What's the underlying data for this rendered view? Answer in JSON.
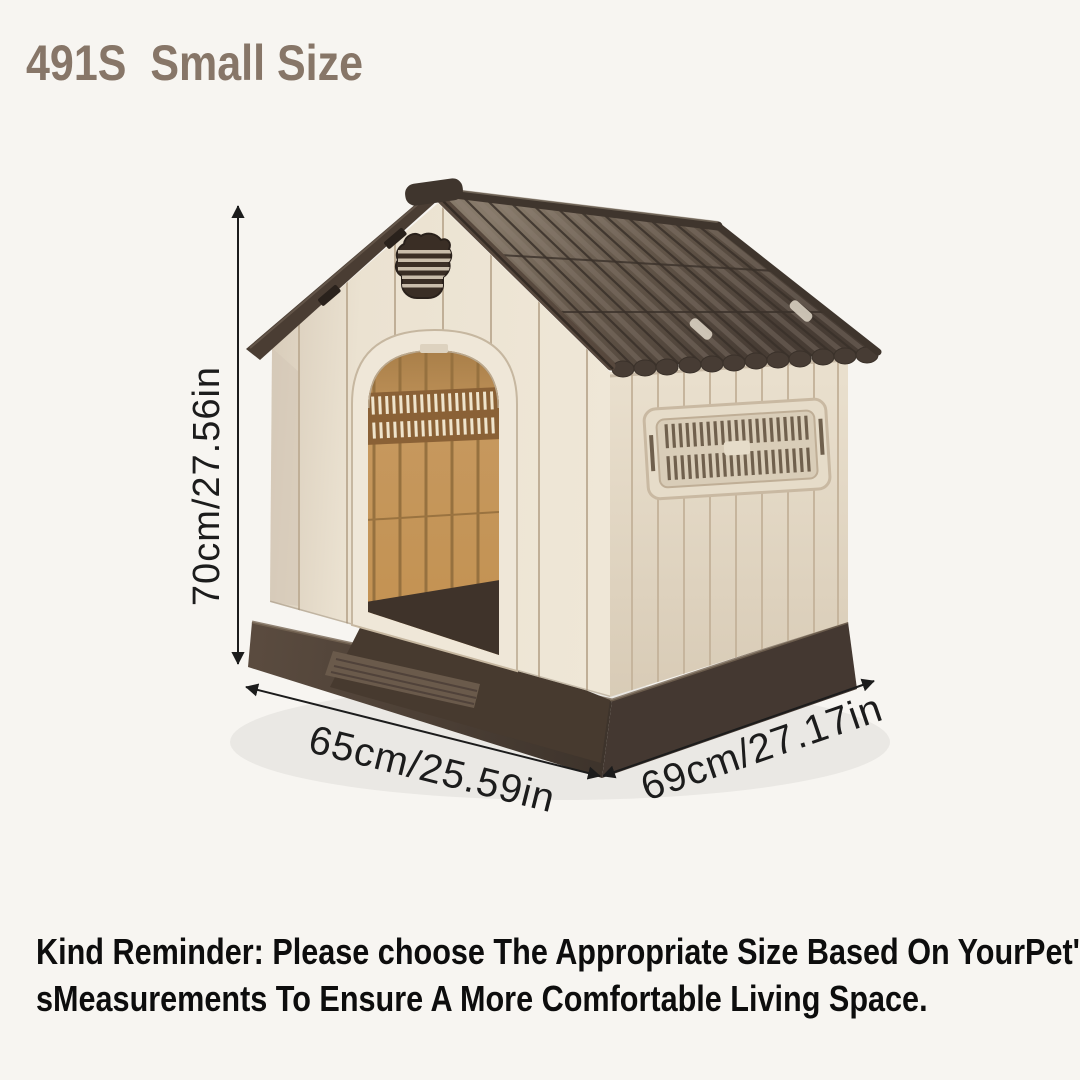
{
  "palette": {
    "bg": "#f7f5f1",
    "title-color": "#877668",
    "dim-ink": "#1c1c1c",
    "reminder-ink": "#0d0d0d",
    "roof": "#5f5349",
    "roof-trim": "#3c332b",
    "wall": "#eae1d0",
    "wall-side": "#e2d8c5",
    "interior": "#c6985e",
    "base": "#4e4237",
    "emblem": "#3a2e25"
  },
  "header": {
    "title": "491S  Small Size"
  },
  "figure": {
    "label": "dog-house-product-illustration",
    "dimensions": {
      "height_label": "70cm/27.56in",
      "width_label": "65cm/25.59in",
      "depth_label": "69cm/27.17in"
    }
  },
  "footer": {
    "reminder_line1": "Kind Reminder: Please choose The Appropriate Size Based On YourPet'",
    "reminder_line2": "sMeasurements To Ensure A More Comfortable Living Space."
  }
}
